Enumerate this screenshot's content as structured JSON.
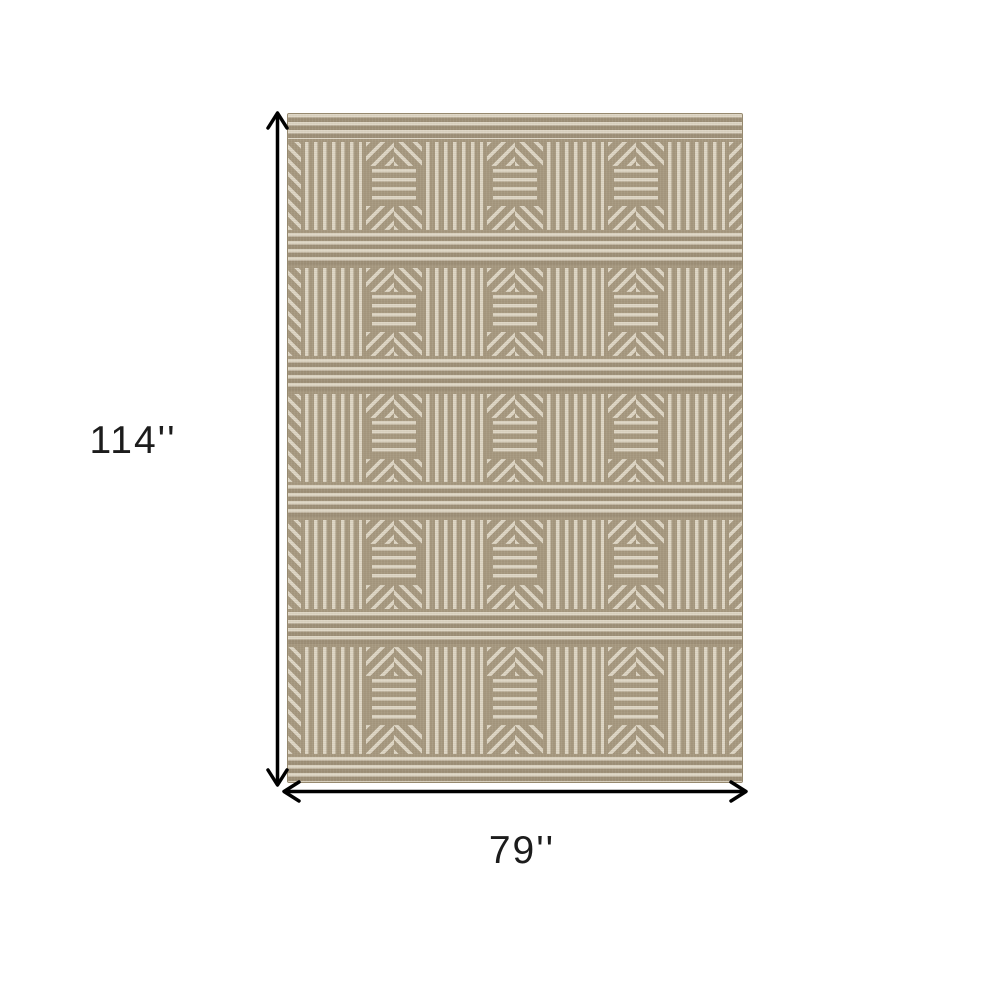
{
  "page": {
    "background": "#ffffff"
  },
  "labels": {
    "height": "114''",
    "width": "79''"
  },
  "arrows": {
    "color": "#000000"
  },
  "rug": {
    "colors": {
      "tan": "#a6987f",
      "cream": "#ded6c5",
      "band_tan": "#9d8f77",
      "edge": "#96896f"
    },
    "rows": 5,
    "row_panels": [
      "sliver-left",
      "vertical",
      "chevron",
      "vertical",
      "chevron",
      "vertical",
      "chevron",
      "vertical",
      "sliver-right"
    ]
  }
}
